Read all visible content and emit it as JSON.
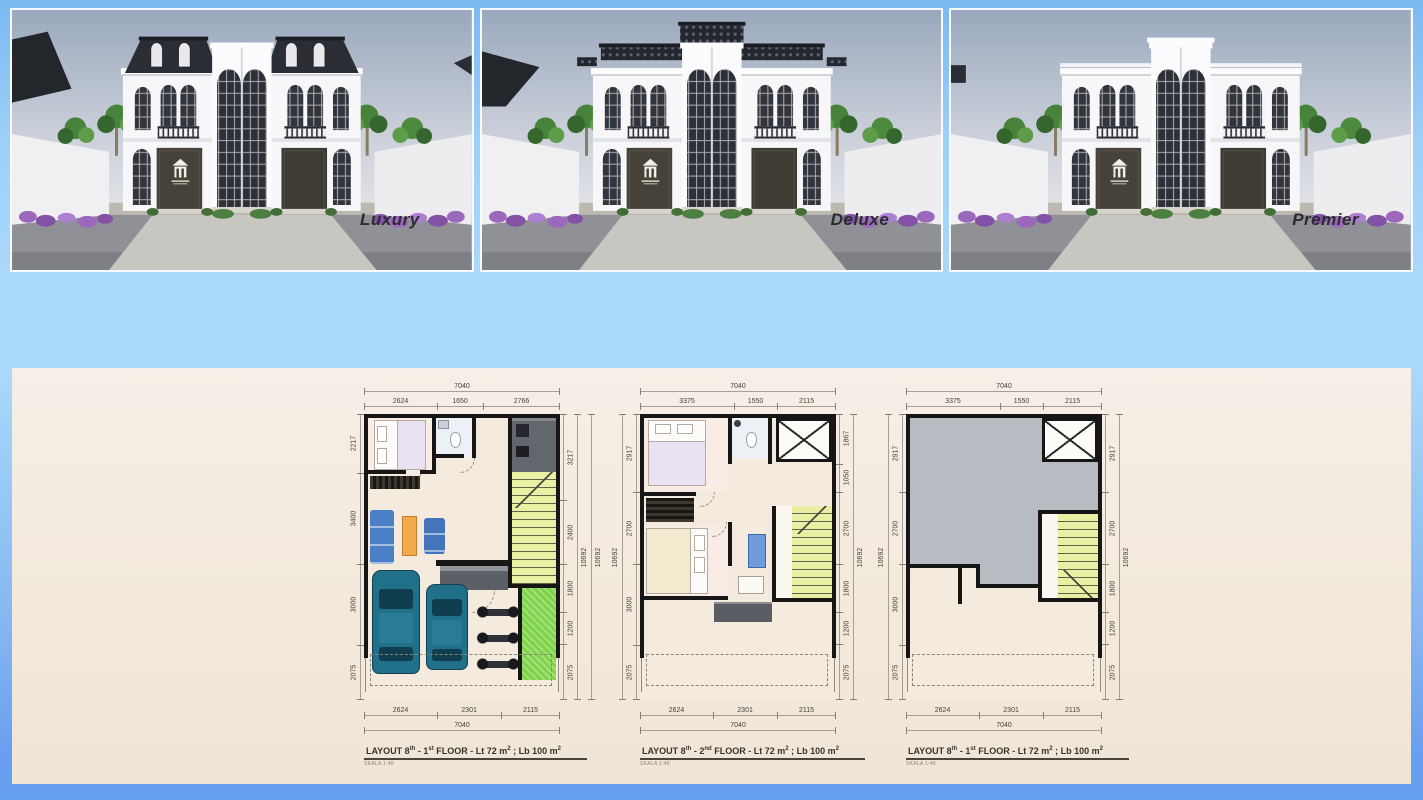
{
  "renders": [
    {
      "label": "Luxury"
    },
    {
      "label": "Deluxe"
    },
    {
      "label": "Premier"
    }
  ],
  "floor_plans": [
    {
      "title_parts": {
        "t1": "LAYOUT 8",
        "s1": "th",
        "t2": " - 1",
        "s2": "st",
        "t3": " FLOOR - Lt 72 m",
        "s3": "2",
        "t4": " ; Lb 100 m",
        "s4": "2"
      },
      "scale_note": "SKALA 1:48",
      "dims": {
        "top_total": "7040",
        "top": [
          "2624",
          "1650",
          "2766"
        ],
        "left": [
          "2217",
          "3400",
          "3000",
          "2075"
        ],
        "right": [
          "3217",
          "2400",
          "1800",
          "1200",
          "2075"
        ],
        "right_totals": [
          "10692",
          "10692"
        ],
        "bottom": [
          "2624",
          "2301",
          "2115"
        ],
        "bottom_total": "7040"
      }
    },
    {
      "title_parts": {
        "t1": "LAYOUT 8",
        "s1": "th",
        "t2": " - 2",
        "s2": "nd",
        "t3": " FLOOR - Lt 72 m",
        "s3": "2",
        "t4": " ; Lb 100 m",
        "s4": "2"
      },
      "scale_note": "SKALA 1:48",
      "dims": {
        "top_total": "7040",
        "top": [
          "3375",
          "1550",
          "2115"
        ],
        "left_total": "10692",
        "left": [
          "2917",
          "2700",
          "3000",
          "2075"
        ],
        "right": [
          "1867",
          "1050",
          "2700",
          "1800",
          "1200",
          "2075"
        ],
        "right_total": "10692",
        "bottom": [
          "2624",
          "2301",
          "2115"
        ],
        "bottom_total": "7040"
      }
    },
    {
      "title_parts": {
        "t1": "LAYOUT 8",
        "s1": "th",
        "t2": " - 1",
        "s2": "st",
        "t3": " FLOOR - Lt 72 m",
        "s3": "2",
        "t4": " ; Lb 100 m",
        "s4": "2"
      },
      "scale_note": "SKALA 1:48",
      "dims": {
        "top_total": "7040",
        "top": [
          "3375",
          "1550",
          "2115"
        ],
        "left_total": "10692",
        "left": [
          "2917",
          "2700",
          "3000",
          "2075"
        ],
        "right": [
          "2917",
          "2700",
          "1800",
          "1200",
          "2075"
        ],
        "right_total": "10692",
        "bottom": [
          "2624",
          "2301",
          "2115"
        ],
        "bottom_total": "7040"
      }
    }
  ],
  "colors": {
    "top_blue": "#7ab9f2",
    "band_blue": "#aad8fb",
    "bottom_blue": "#67a0ef",
    "board_cream": "#f3e9dd",
    "wall_black": "#161616",
    "stair_yellow": "#e9efa3",
    "grass_green": "#7fd348",
    "car_teal": "#21708a",
    "deck_gray": "#b7bbc2",
    "sky_gray": "#9aa8bd"
  }
}
